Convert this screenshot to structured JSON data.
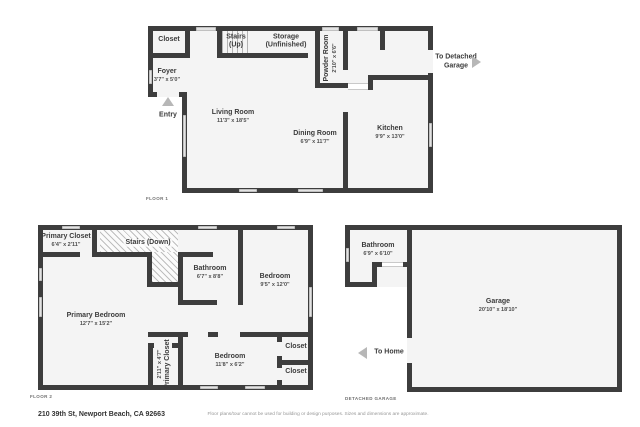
{
  "colors": {
    "wall": "#3d3d3d",
    "floor": "#f4f4f4",
    "window": "#e3e3e3",
    "arrow": "#b7b7b7",
    "hatch_line": "#969696"
  },
  "floor1": {
    "section_label": "FLOOR 1",
    "rooms": {
      "closet": {
        "name": "Closet"
      },
      "stairs": {
        "name": "Stairs (Up)"
      },
      "storage": {
        "name": "Storage (Unfinished)"
      },
      "powder": {
        "name": "Powder Room",
        "dims": "2'10\" x 6'6\""
      },
      "foyer": {
        "name": "Foyer",
        "dims": "3'7\" x 5'0\""
      },
      "living": {
        "name": "Living Room",
        "dims": "11'3\" x 18'5\""
      },
      "dining": {
        "name": "Dining Room",
        "dims": "6'9\" x 11'7\""
      },
      "kitchen": {
        "name": "Kitchen",
        "dims": "9'9\" x 13'0\""
      }
    },
    "annotations": {
      "entry": "Entry",
      "to_detached_garage": "To Detached Garage"
    }
  },
  "floor2": {
    "section_label": "FLOOR 2",
    "rooms": {
      "primary_closet_top": {
        "name": "Primary Closet",
        "dims": "6'4\" x 2'11\""
      },
      "stairs": {
        "name": "Stairs (Down)"
      },
      "bathroom": {
        "name": "Bathroom",
        "dims": "6'7\" x 8'8\""
      },
      "bedroom_upper": {
        "name": "Bedroom",
        "dims": "9'5\" x 12'0\""
      },
      "primary_bedroom": {
        "name": "Primary Bedroom",
        "dims": "12'7\" x 15'2\""
      },
      "primary_closet_lower": {
        "name": "Primary Closet",
        "dims": "2'11\" x 4'7\""
      },
      "bedroom_lower": {
        "name": "Bedroom",
        "dims": "11'8\" x 6'2\""
      },
      "closet_upper": {
        "name": "Closet"
      },
      "closet_lower": {
        "name": "Closet"
      }
    }
  },
  "garage": {
    "section_label": "DETACHED GARAGE",
    "rooms": {
      "bathroom": {
        "name": "Bathroom",
        "dims": "6'9\" x 6'10\""
      },
      "garage": {
        "name": "Garage",
        "dims": "20'10\" x 18'10\""
      }
    },
    "annotations": {
      "to_home": "To Home"
    }
  },
  "footer": {
    "address": "210 39th St, Newport Beach, CA 92663",
    "disclaimer": "Floor plans/tour cannot be used for building or design purposes. Sizes and dimensions are approximate."
  }
}
